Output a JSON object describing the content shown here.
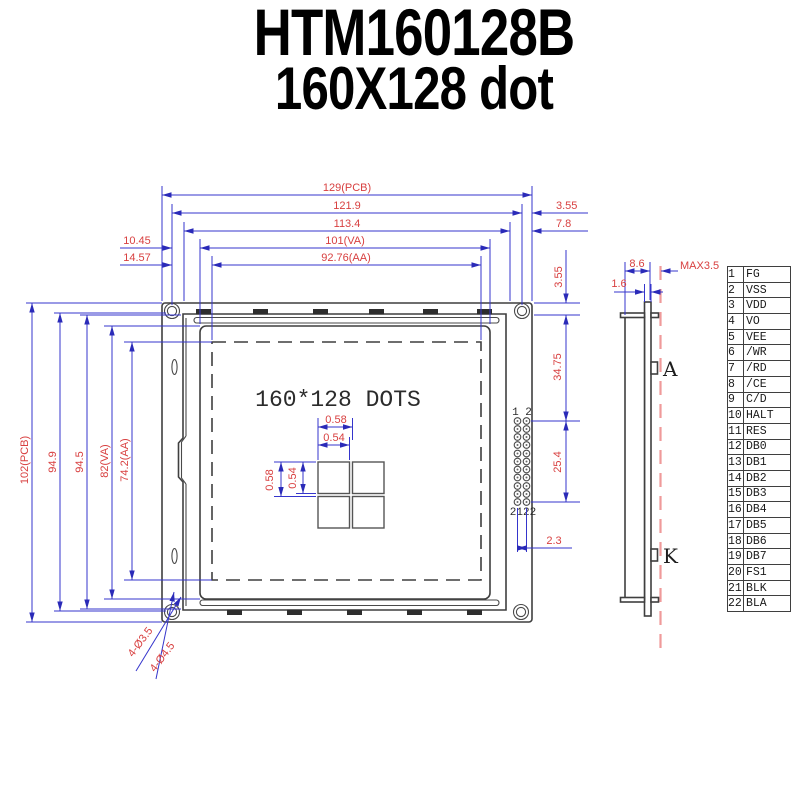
{
  "title": {
    "line1": "HTM160128B",
    "line2": "160X128 dot"
  },
  "colors": {
    "dim_line": "#3535cc",
    "dim_text": "#d84040",
    "outline": "#3f3f3f",
    "centerline": "#ef9a9a"
  },
  "front_view": {
    "dots_label": "160*128 DOTS",
    "pin_top_label": "1 2",
    "pin_bottom_label": "2122",
    "dims": {
      "pcb_w": "129(PCB)",
      "hole_span_w": "121.9",
      "frame_w": "113.4",
      "va_w": "101(VA)",
      "aa_w": "92.76(AA)",
      "va_left_offset": "10.45",
      "aa_left_offset": "14.57",
      "hole_edge_offset": "3.55",
      "frame_edge_offset": "7.8",
      "top_edge_offset": "3.55",
      "pcb_h": "102(PCB)",
      "hole_span_h": "94.9",
      "frame_h": "94.5",
      "va_h": "82(VA)",
      "aa_h": "74.2(AA)",
      "pin_top_offset": "34.75",
      "pin_span": "25.4",
      "pin_col_pitch": "2.3",
      "dot_pitch_x": "0.58",
      "dot_w": "0.54",
      "dot_pitch_y": "0.58",
      "dot_h": "0.54",
      "hole_dia_inner": "4-Ø3.5",
      "hole_dia_outer": "4-Ø4.5"
    }
  },
  "side_view": {
    "dims": {
      "total_thickness": "8.6",
      "max_component": "MAX3.5",
      "pcb_thickness": "1.6"
    },
    "anode_label": "A",
    "cathode_label": "K"
  },
  "pin_table": {
    "rows": [
      {
        "pin": "1",
        "name": "FG"
      },
      {
        "pin": "2",
        "name": "VSS"
      },
      {
        "pin": "3",
        "name": "VDD"
      },
      {
        "pin": "4",
        "name": "VO"
      },
      {
        "pin": "5",
        "name": "VEE"
      },
      {
        "pin": "6",
        "name": "/WR"
      },
      {
        "pin": "7",
        "name": "/RD"
      },
      {
        "pin": "8",
        "name": "/CE"
      },
      {
        "pin": "9",
        "name": "C/D"
      },
      {
        "pin": "10",
        "name": "HALT"
      },
      {
        "pin": "11",
        "name": "RES"
      },
      {
        "pin": "12",
        "name": "DB0"
      },
      {
        "pin": "13",
        "name": "DB1"
      },
      {
        "pin": "14",
        "name": "DB2"
      },
      {
        "pin": "15",
        "name": "DB3"
      },
      {
        "pin": "16",
        "name": "DB4"
      },
      {
        "pin": "17",
        "name": "DB5"
      },
      {
        "pin": "18",
        "name": "DB6"
      },
      {
        "pin": "19",
        "name": "DB7"
      },
      {
        "pin": "20",
        "name": "FS1"
      },
      {
        "pin": "21",
        "name": "BLK"
      },
      {
        "pin": "22",
        "name": "BLA"
      }
    ]
  }
}
